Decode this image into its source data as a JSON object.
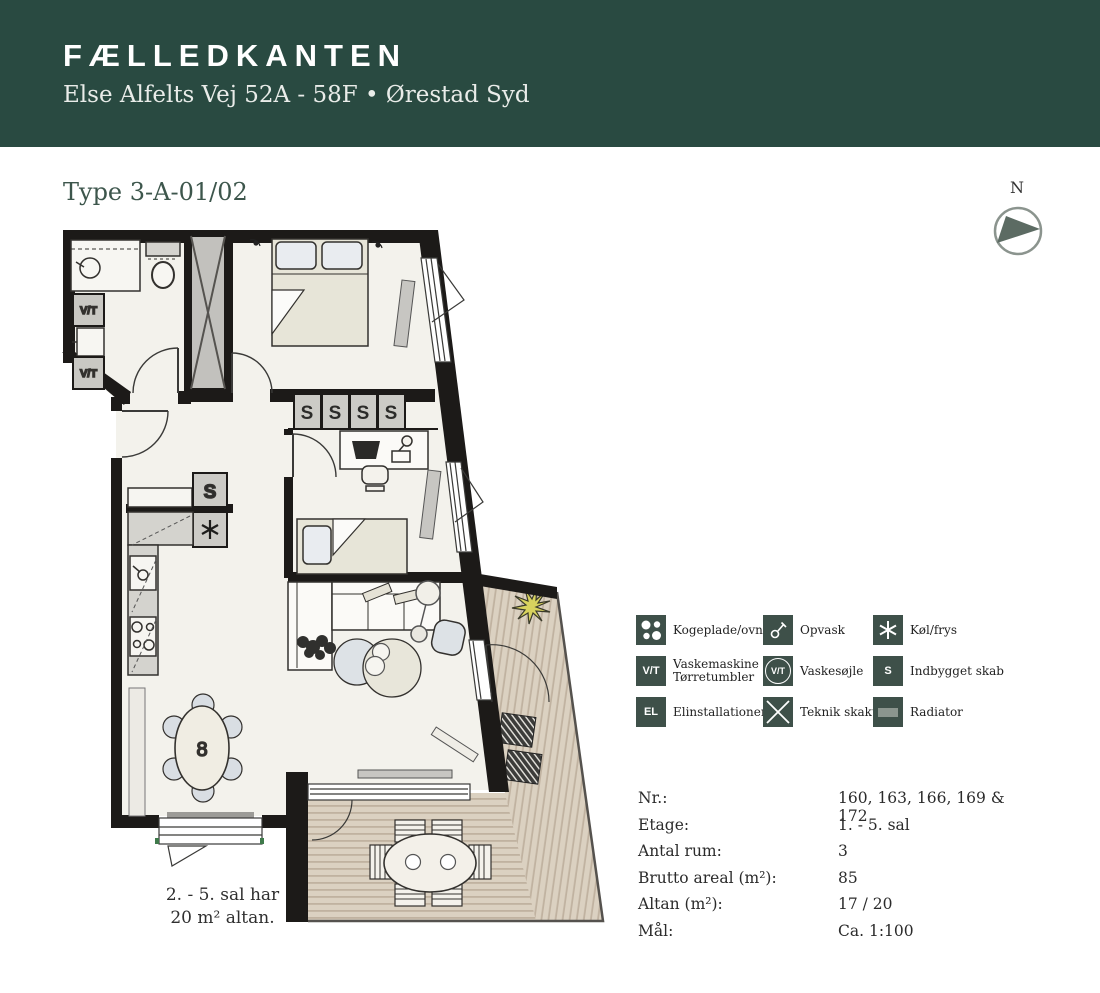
{
  "header": {
    "title": "FÆLLEDKANTEN",
    "subtitle": "Else Alfelts Vej 52A - 58F • Ørestad Syd"
  },
  "plan": {
    "type_label": "Type 3-A-01/02",
    "compass_label": "N",
    "note_line1": "2. - 5. sal har",
    "note_line2": "20 m² altan.",
    "labels": {
      "vt": "V/T",
      "s": "S",
      "table_decor": "8"
    }
  },
  "legend": {
    "items": [
      {
        "icon": "cooktop-icon",
        "label": "Kogeplade/ovn"
      },
      {
        "icon": "dishwasher-icon",
        "label": "Opvask"
      },
      {
        "icon": "fridge-freezer-icon",
        "label": "Køl/frys"
      },
      {
        "icon": "washer-dryer-icon",
        "icon_text": "V/T",
        "label": "Vaskemaskine",
        "label2": "Tørretumbler"
      },
      {
        "icon": "washer-column-icon",
        "icon_text": "V/T",
        "label": "Vaskesøjle"
      },
      {
        "icon": "built-in-closet-icon",
        "icon_text": "S",
        "label": "Indbygget skab"
      },
      {
        "icon": "electrical-icon",
        "icon_text": "EL",
        "label": "Elinstallationer"
      },
      {
        "icon": "technical-shaft-icon",
        "label": "Teknik skakt"
      },
      {
        "icon": "radiator-icon",
        "label": "Radiator"
      }
    ]
  },
  "details": {
    "rows": [
      {
        "label": "Nr.:",
        "value": "160, 163, 166, 169 & 172"
      },
      {
        "label": "Etage:",
        "value": "1. - 5. sal"
      },
      {
        "label": "Antal rum:",
        "value": "3"
      },
      {
        "label": "Brutto areal (m²):",
        "value": "85"
      },
      {
        "label": "Altan (m²):",
        "value": "17 / 20"
      },
      {
        "label": "Mål:",
        "value": "Ca. 1:100"
      }
    ]
  },
  "colors": {
    "header_bg": "#294a41",
    "legend_icon_bg": "#3e5049",
    "heading": "#3d564c",
    "wall": "#1c1a18",
    "room_fill": "#f3f2ec",
    "deck_fill": "#dbd1c1",
    "deck_stripe": "#c0b2a0"
  }
}
